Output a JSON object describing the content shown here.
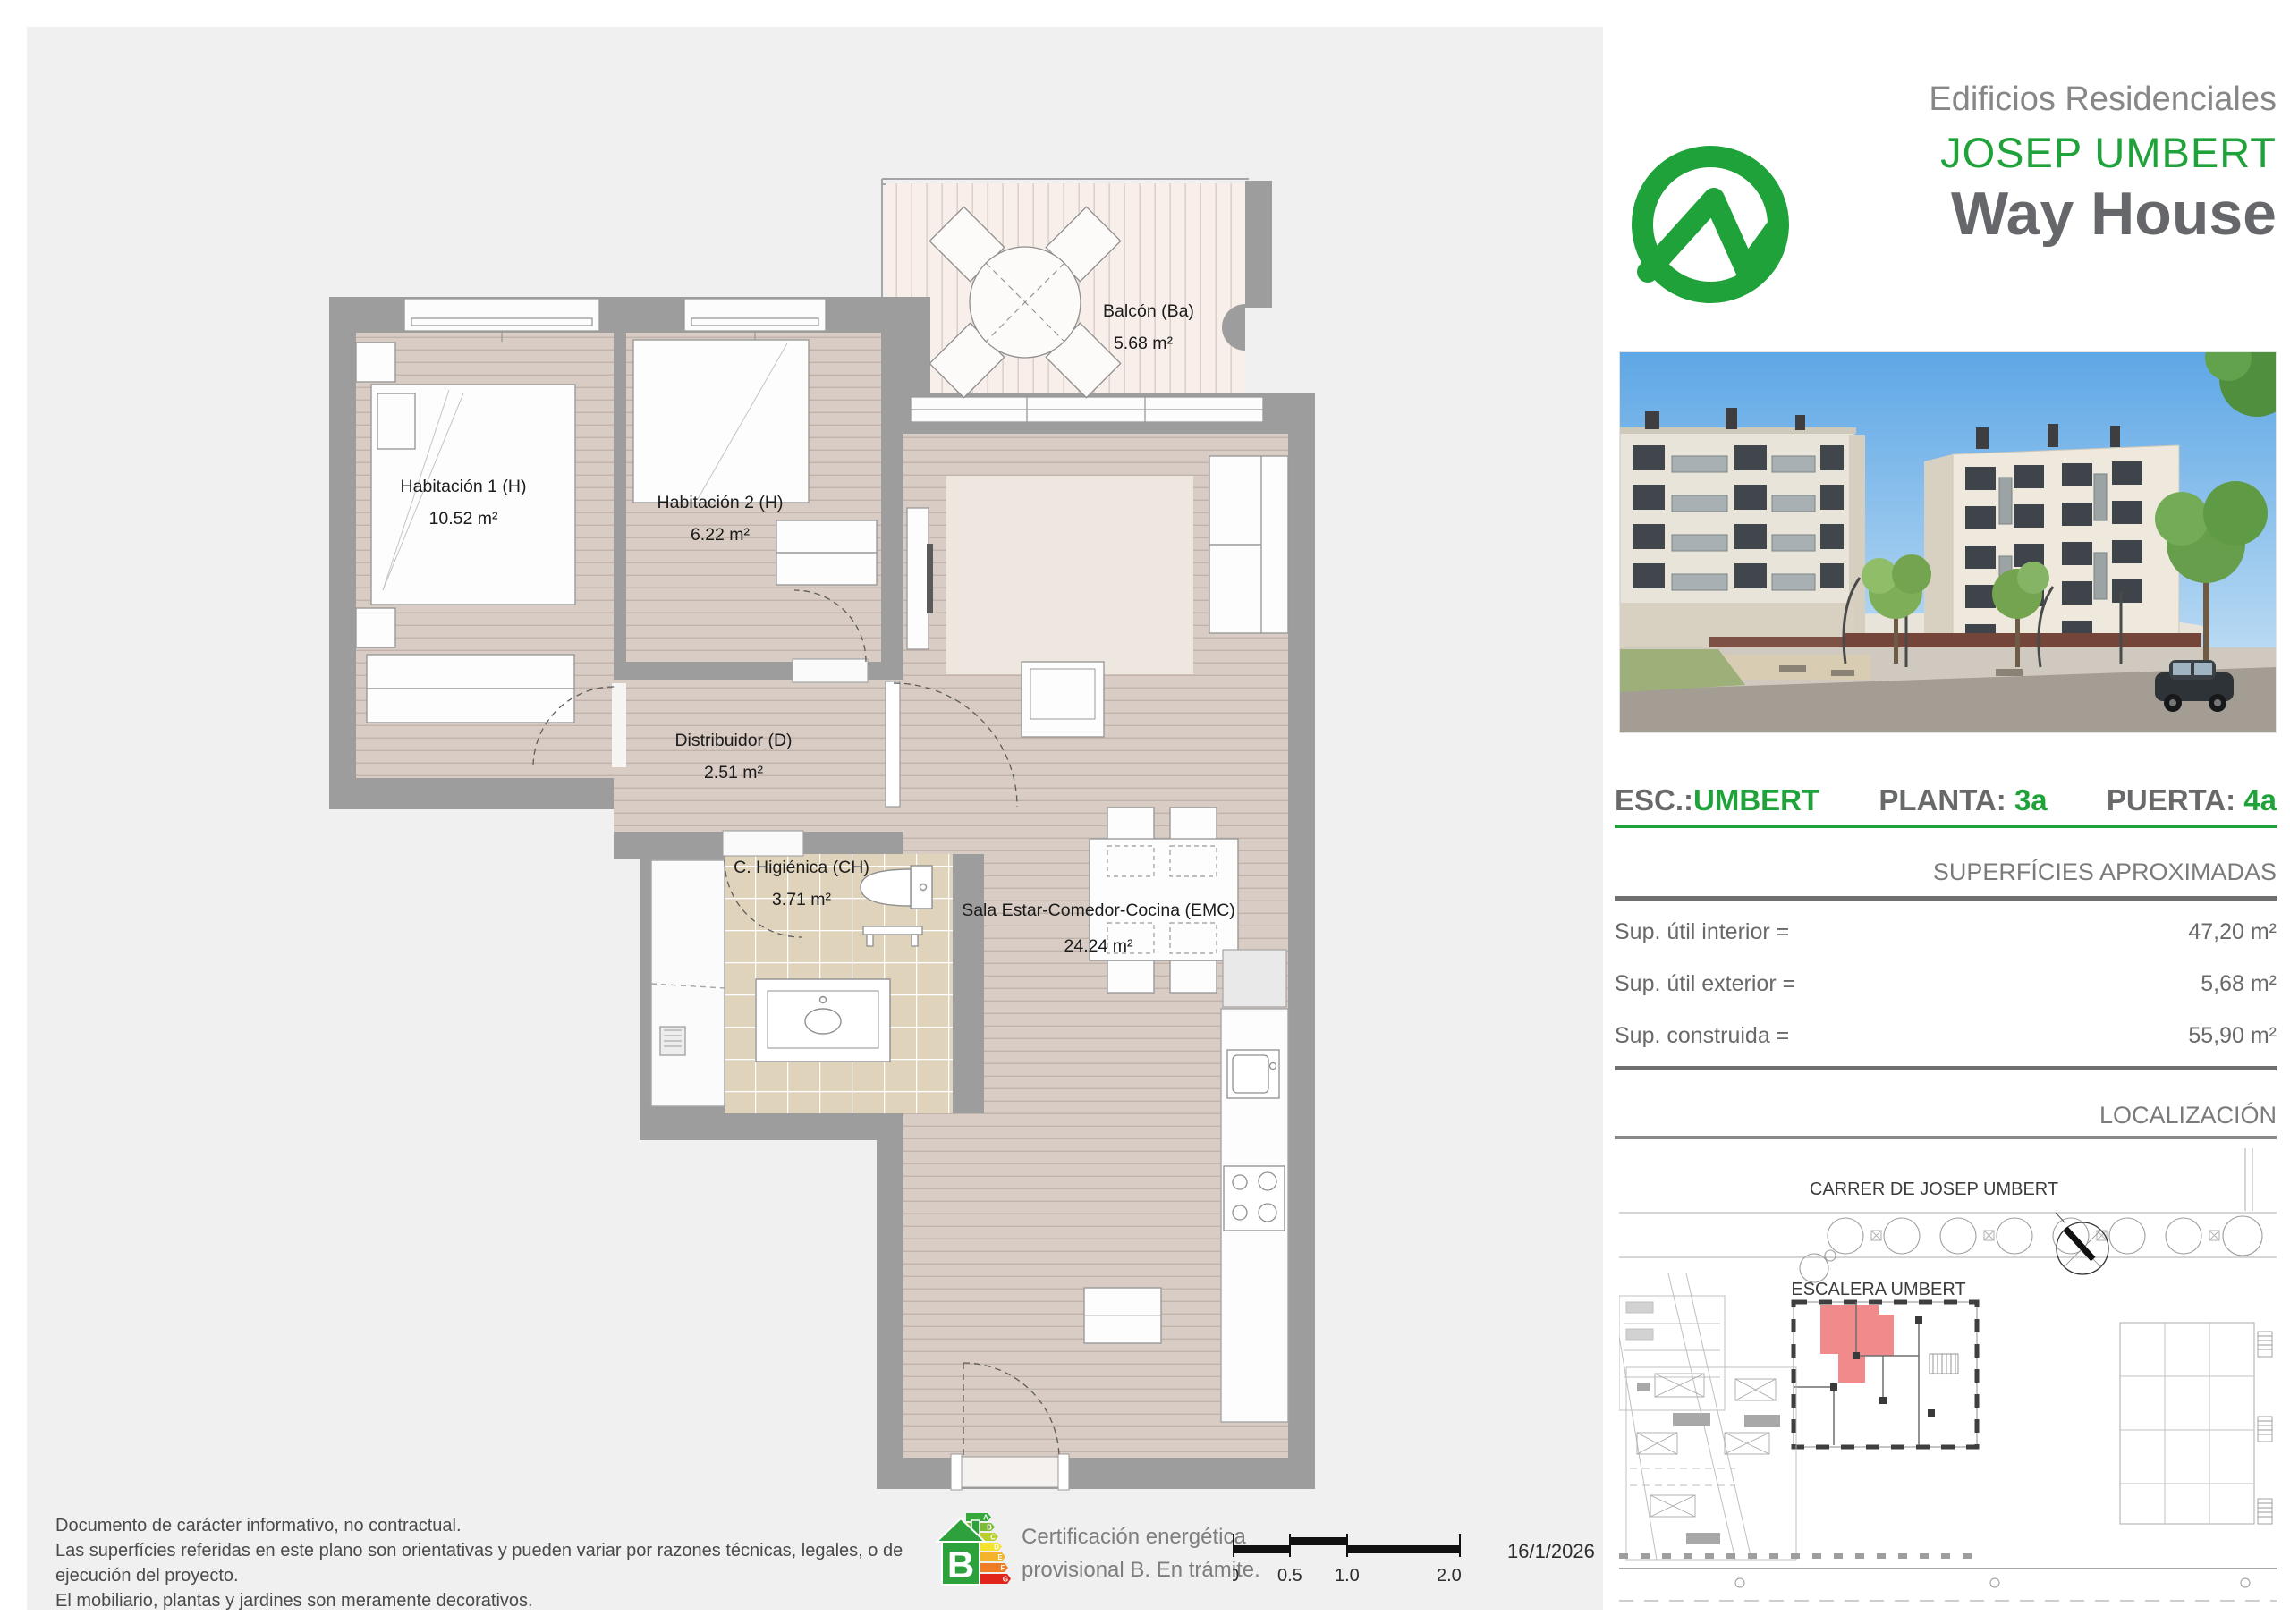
{
  "header": {
    "kicker": "Edificios Residenciales",
    "brand": "JOSEP UMBERT",
    "product": "Way House",
    "brand_green": "#1fa23a",
    "logo_icon": "wave-circle-logo"
  },
  "unit": {
    "esc_label": "ESC.:",
    "esc_value": "UMBERT",
    "planta_label": "PLANTA:",
    "planta_value": "3a",
    "puerta_label": "PUERTA:",
    "puerta_value": "4a"
  },
  "surfaces": {
    "title": "SUPERFÍCIES APROXIMADAS",
    "rows": [
      {
        "label": "Sup. útil interior =",
        "value": "47,20  m²"
      },
      {
        "label": "Sup. útil exterior =",
        "value": "5,68  m²"
      },
      {
        "label": "Sup. construida =",
        "value": "55,90  m²"
      }
    ]
  },
  "location": {
    "title": "LOCALIZACIÓN",
    "street": "CARRER DE JOSEP UMBERT",
    "stair": "ESCALERA UMBERT",
    "highlight_color": "#f18a8a"
  },
  "plan": {
    "rooms": [
      {
        "name": "Habitación 1 (H)",
        "area": "10.52 m²"
      },
      {
        "name": "Habitación 2 (H)",
        "area": "6.22 m²"
      },
      {
        "name": "Distribuidor (D)",
        "area": "2.51 m²"
      },
      {
        "name": "C. Higiénica (CH)",
        "area": "3.71 m²"
      },
      {
        "name": "Sala Estar-Comedor-Cocina (EMC)",
        "area": "24.24 m²"
      },
      {
        "name": "Balcón (Ba)",
        "area": "5.68 m²"
      }
    ],
    "wall_color": "#9d9d9d",
    "wood_color": "#d8ccc4",
    "deck_color": "#f8eeea",
    "tile_color": "#e0d3bb",
    "entrance_marker_color": "#aeb58f"
  },
  "footer": {
    "disclaimer": [
      "Documento de carácter informativo, no contractual.",
      "Las superfícies referidas en este plano son orientativas y pueden variar por razones técnicas, legales, o de ejecución del proyecto.",
      "El mobiliario, plantas y jardines son meramente decorativos."
    ],
    "energy": {
      "line1": "Certificación energética",
      "line2": "provisional B. En trámite.",
      "rating": "B",
      "letters": [
        "A",
        "B",
        "C",
        "D",
        "E",
        "F",
        "G"
      ]
    },
    "scale": {
      "ticks": [
        "0",
        "0.5",
        "1.0",
        "2.0 m."
      ]
    },
    "date": "16/1/2026"
  }
}
